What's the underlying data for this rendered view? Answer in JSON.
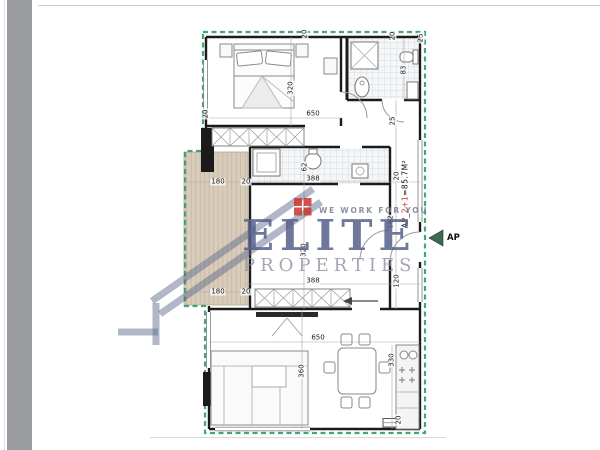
{
  "document": {
    "kind": "apartment floor plan with realtor watermark"
  },
  "watermark": {
    "brand": "ELITE",
    "subbrand": "PROPERTIES",
    "tagline": "WE WORK FOR YOU"
  },
  "apartment": {
    "label_prefix": "AP_",
    "label_highlight": "2+1",
    "label_suffix": "=85.7M²",
    "entry_label": "AP"
  },
  "colors": {
    "insulation_green": "#2f9e63",
    "terrace_fill": "#d9ccbb",
    "terrace_hatch": "#c7b8a5",
    "wall_black": "#1b1b1b",
    "watermark_main": "#56618a",
    "watermark_sub": "#9298a6",
    "logo_red": "#c8372d",
    "entry_arrow": "#3a6b51"
  },
  "dimensions": [
    {
      "text": "650",
      "x": 313,
      "y": 114,
      "v": false
    },
    {
      "text": "320",
      "x": 291,
      "y": 88,
      "v": true
    },
    {
      "text": "20",
      "x": 305,
      "y": 34,
      "v": true
    },
    {
      "text": "20",
      "x": 393,
      "y": 36,
      "v": true
    },
    {
      "text": "25",
      "x": 421,
      "y": 38,
      "v": true
    },
    {
      "text": "83",
      "x": 404,
      "y": 70,
      "v": true
    },
    {
      "text": "25",
      "x": 393,
      "y": 121,
      "v": true
    },
    {
      "text": "20",
      "x": 206,
      "y": 114,
      "v": true
    },
    {
      "text": "180",
      "x": 218,
      "y": 182,
      "v": false
    },
    {
      "text": "20",
      "x": 246,
      "y": 182,
      "v": false
    },
    {
      "text": "62",
      "x": 305,
      "y": 167,
      "v": true
    },
    {
      "text": "388",
      "x": 313,
      "y": 179,
      "v": false
    },
    {
      "text": "20",
      "x": 397,
      "y": 176,
      "v": true
    },
    {
      "text": "182",
      "x": 391,
      "y": 222,
      "v": true
    },
    {
      "text": "320",
      "x": 304,
      "y": 250,
      "v": true
    },
    {
      "text": "180",
      "x": 218,
      "y": 292,
      "v": false
    },
    {
      "text": "20",
      "x": 246,
      "y": 292,
      "v": false
    },
    {
      "text": "388",
      "x": 313,
      "y": 281,
      "v": false
    },
    {
      "text": "120",
      "x": 397,
      "y": 281,
      "v": true
    },
    {
      "text": "650",
      "x": 318,
      "y": 338,
      "v": false
    },
    {
      "text": "360",
      "x": 302,
      "y": 371,
      "v": true
    },
    {
      "text": "330",
      "x": 392,
      "y": 360,
      "v": true
    },
    {
      "text": "20",
      "x": 399,
      "y": 420,
      "v": true
    }
  ]
}
